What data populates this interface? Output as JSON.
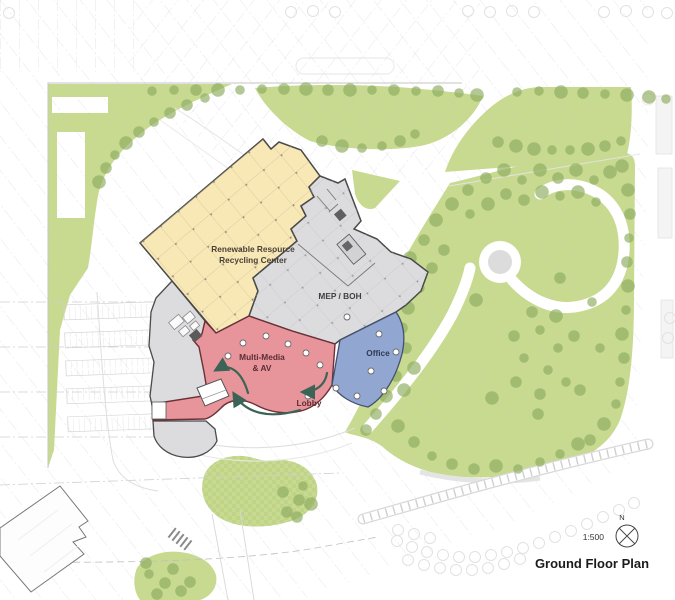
{
  "legend": {
    "scale": "1:500",
    "north": "N",
    "title": "Ground Floor Plan"
  },
  "zones": {
    "recycling": {
      "line1": "Renewable Resource",
      "line2": "Recycling Center",
      "color": "#f8e8b6"
    },
    "mep": {
      "label": "MEP / BOH",
      "color": "#dcdcde"
    },
    "multimedia": {
      "line1": "Multi-Media",
      "line2": "& AV",
      "color": "#e8949b"
    },
    "lobby": {
      "label": "Lobby"
    },
    "office": {
      "label": "Office",
      "color": "#91a7d2"
    },
    "west_wing_color": "#dcdcde"
  },
  "colors": {
    "landscape": "#c8da90",
    "tree": "#8fae63",
    "arrow": "#3c6456",
    "wall": "#4a4a4a",
    "faint": "#e2e2e2",
    "plaza": "#dcdcdd"
  },
  "landscape": {
    "trees": [
      [
        152,
        91
      ],
      [
        174,
        90
      ],
      [
        196,
        90
      ],
      [
        218,
        90
      ],
      [
        240,
        90
      ],
      [
        262,
        89
      ],
      [
        284,
        89
      ],
      [
        306,
        89
      ],
      [
        328,
        90
      ],
      [
        350,
        90
      ],
      [
        372,
        90
      ],
      [
        394,
        90
      ],
      [
        416,
        91
      ],
      [
        438,
        91
      ],
      [
        459,
        93
      ],
      [
        477,
        95
      ],
      [
        517,
        92
      ],
      [
        539,
        91
      ],
      [
        561,
        92
      ],
      [
        583,
        93
      ],
      [
        605,
        94
      ],
      [
        627,
        95
      ],
      [
        649,
        97
      ],
      [
        666,
        99
      ],
      [
        498,
        142
      ],
      [
        516,
        146
      ],
      [
        534,
        149
      ],
      [
        552,
        150
      ],
      [
        570,
        150
      ],
      [
        588,
        149
      ],
      [
        605,
        146
      ],
      [
        621,
        141
      ],
      [
        205,
        98
      ],
      [
        187,
        105
      ],
      [
        170,
        113
      ],
      [
        154,
        122
      ],
      [
        139,
        132
      ],
      [
        126,
        143
      ],
      [
        115,
        155
      ],
      [
        106,
        168
      ],
      [
        99,
        182
      ],
      [
        322,
        141
      ],
      [
        342,
        146
      ],
      [
        362,
        148
      ],
      [
        382,
        146
      ],
      [
        400,
        141
      ],
      [
        415,
        134
      ],
      [
        622,
        166
      ],
      [
        628,
        190
      ],
      [
        630,
        214
      ],
      [
        629,
        238
      ],
      [
        627,
        262
      ],
      [
        628,
        286
      ],
      [
        626,
        310
      ],
      [
        622,
        334
      ],
      [
        624,
        358
      ],
      [
        620,
        382
      ],
      [
        616,
        404
      ],
      [
        604,
        424
      ],
      [
        590,
        440
      ],
      [
        468,
        190
      ],
      [
        486,
        178
      ],
      [
        504,
        170
      ],
      [
        522,
        180
      ],
      [
        540,
        170
      ],
      [
        558,
        178
      ],
      [
        576,
        170
      ],
      [
        594,
        180
      ],
      [
        610,
        172
      ],
      [
        452,
        204
      ],
      [
        470,
        214
      ],
      [
        488,
        204
      ],
      [
        506,
        194
      ],
      [
        524,
        200
      ],
      [
        542,
        192
      ],
      [
        560,
        196
      ],
      [
        578,
        192
      ],
      [
        596,
        202
      ],
      [
        436,
        220
      ],
      [
        424,
        240
      ],
      [
        410,
        258
      ],
      [
        398,
        276
      ],
      [
        390,
        296
      ],
      [
        384,
        316
      ],
      [
        380,
        336
      ],
      [
        388,
        356
      ],
      [
        396,
        376
      ],
      [
        386,
        396
      ],
      [
        376,
        414
      ],
      [
        444,
        250
      ],
      [
        432,
        268
      ],
      [
        420,
        288
      ],
      [
        408,
        308
      ],
      [
        402,
        328
      ],
      [
        406,
        348
      ],
      [
        414,
        368
      ],
      [
        404,
        390
      ],
      [
        398,
        426
      ],
      [
        414,
        442
      ],
      [
        432,
        456
      ],
      [
        452,
        464
      ],
      [
        474,
        469
      ],
      [
        496,
        466
      ],
      [
        518,
        469
      ],
      [
        540,
        462
      ],
      [
        560,
        454
      ],
      [
        578,
        444
      ],
      [
        366,
        430
      ],
      [
        540,
        330
      ],
      [
        558,
        348
      ],
      [
        548,
        370
      ],
      [
        524,
        358
      ],
      [
        514,
        336
      ],
      [
        532,
        312
      ],
      [
        556,
        316
      ],
      [
        574,
        336
      ],
      [
        566,
        382
      ],
      [
        540,
        394
      ],
      [
        516,
        382
      ],
      [
        476,
        300
      ],
      [
        492,
        398
      ],
      [
        538,
        414
      ],
      [
        580,
        390
      ],
      [
        600,
        348
      ],
      [
        592,
        302
      ],
      [
        560,
        278
      ],
      [
        283,
        492
      ],
      [
        299,
        500
      ],
      [
        287,
        512
      ],
      [
        303,
        486
      ],
      [
        297,
        517
      ],
      [
        311,
        504
      ],
      [
        149,
        574
      ],
      [
        165,
        583
      ],
      [
        181,
        591
      ],
      [
        157,
        594
      ],
      [
        173,
        569
      ],
      [
        190,
        582
      ],
      [
        146,
        563
      ]
    ],
    "faint_circles": [
      [
        9,
        13
      ],
      [
        291,
        12
      ],
      [
        313,
        11
      ],
      [
        335,
        12
      ],
      [
        468,
        11
      ],
      [
        490,
        12
      ],
      [
        512,
        11
      ],
      [
        534,
        12
      ],
      [
        604,
        12
      ],
      [
        626,
        11
      ],
      [
        648,
        12
      ],
      [
        667,
        13
      ],
      [
        397,
        541
      ],
      [
        412,
        547
      ],
      [
        427,
        552
      ],
      [
        443,
        555
      ],
      [
        459,
        557
      ],
      [
        475,
        557
      ],
      [
        491,
        555
      ],
      [
        507,
        552
      ],
      [
        523,
        548
      ],
      [
        539,
        543
      ],
      [
        555,
        537
      ],
      [
        571,
        531
      ],
      [
        587,
        524
      ],
      [
        603,
        517
      ],
      [
        619,
        510
      ],
      [
        634,
        503
      ],
      [
        408,
        560
      ],
      [
        424,
        565
      ],
      [
        440,
        568
      ],
      [
        456,
        570
      ],
      [
        472,
        570
      ],
      [
        488,
        568
      ],
      [
        504,
        564
      ],
      [
        520,
        559
      ],
      [
        398,
        530
      ],
      [
        414,
        534
      ],
      [
        430,
        538
      ],
      [
        670,
        318
      ],
      [
        668,
        338
      ]
    ]
  },
  "building": {
    "columns_red": [
      [
        243,
        343
      ],
      [
        266,
        336
      ],
      [
        288,
        344
      ],
      [
        306,
        353
      ],
      [
        320,
        365
      ],
      [
        308,
        396
      ],
      [
        336,
        388
      ],
      [
        228,
        356
      ]
    ],
    "columns_blue": [
      [
        347,
        317
      ],
      [
        379,
        334
      ],
      [
        396,
        352
      ],
      [
        371,
        371
      ],
      [
        384,
        391
      ],
      [
        357,
        396
      ]
    ]
  }
}
